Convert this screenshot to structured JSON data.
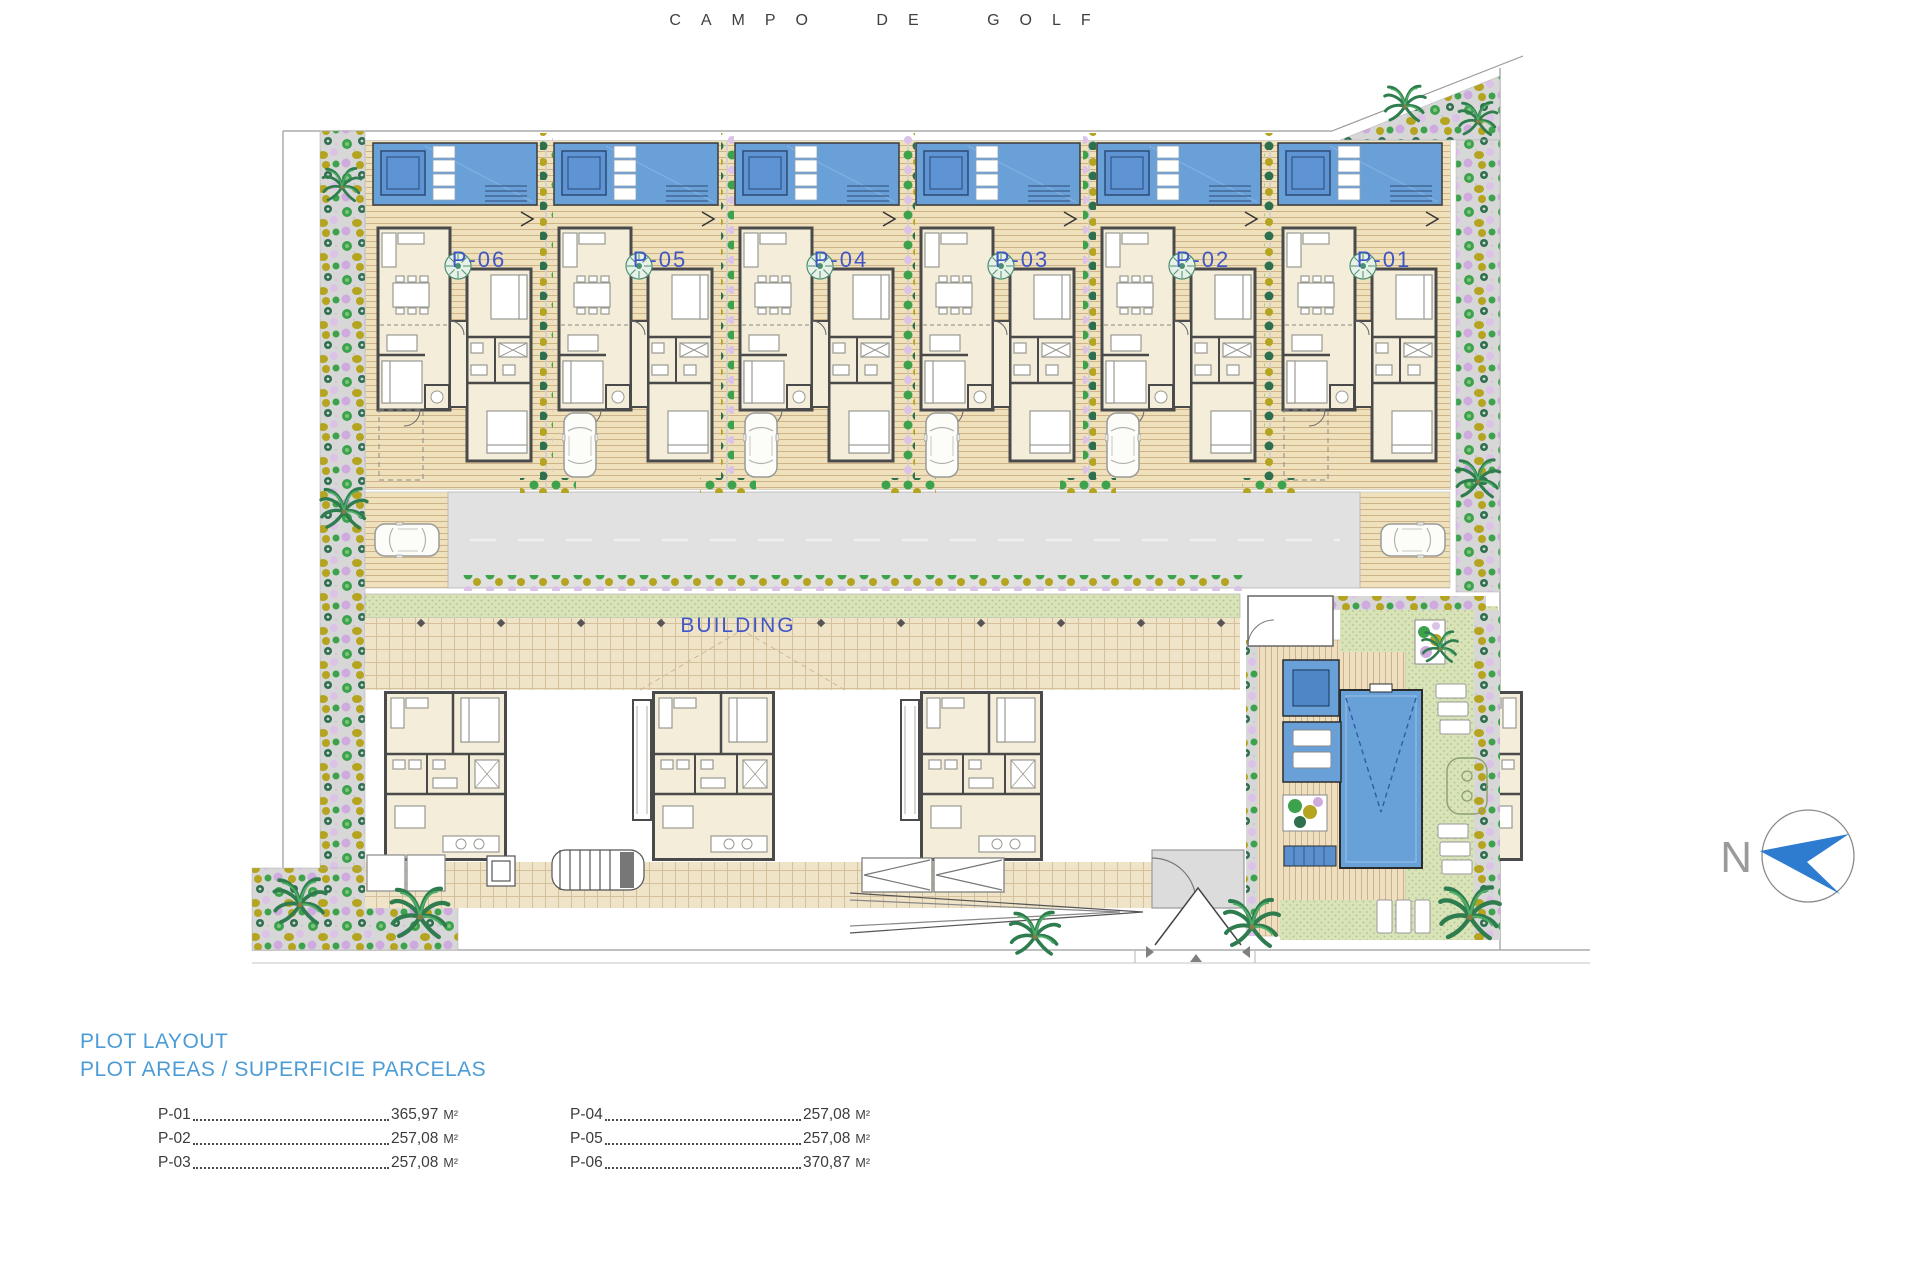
{
  "title": "CAMPO DE GOLF",
  "building_label": "BUILDING",
  "north_label": "N",
  "plots": [
    {
      "label": "P-06"
    },
    {
      "label": "P-05"
    },
    {
      "label": "P-04"
    },
    {
      "label": "P-03"
    },
    {
      "label": "P-02"
    },
    {
      "label": "P-01"
    }
  ],
  "legend": {
    "title": "PLOT LAYOUT",
    "subtitle": "PLOT AREAS / SUPERFICIE PARCELAS",
    "columns": [
      [
        {
          "label": "P-01",
          "value": "365,97",
          "unit": "M²"
        },
        {
          "label": "P-02",
          "value": "257,08",
          "unit": "M²"
        },
        {
          "label": "P-03",
          "value": "257,08",
          "unit": "M²"
        }
      ],
      [
        {
          "label": "P-04",
          "value": "257,08",
          "unit": "M²"
        },
        {
          "label": "P-05",
          "value": "257,08",
          "unit": "M²"
        },
        {
          "label": "P-06",
          "value": "370,87",
          "unit": "M²"
        }
      ]
    ]
  },
  "colors": {
    "plan_label_blue": "#4156c6",
    "legend_blue": "#4b9cd6",
    "pool_blue": "#6aa0d8",
    "pool_dark_blue": "#4f86c6",
    "north_arrow_blue": "#2e7cd0",
    "deck_tan": "#f0e1bd",
    "tile_tan": "#efe3c8",
    "lawn_green": "#d9e3b8",
    "garden_gray": "#d7d7d7",
    "wall_gray": "#4a4a4a",
    "road_gray": "#e1e1e1"
  }
}
